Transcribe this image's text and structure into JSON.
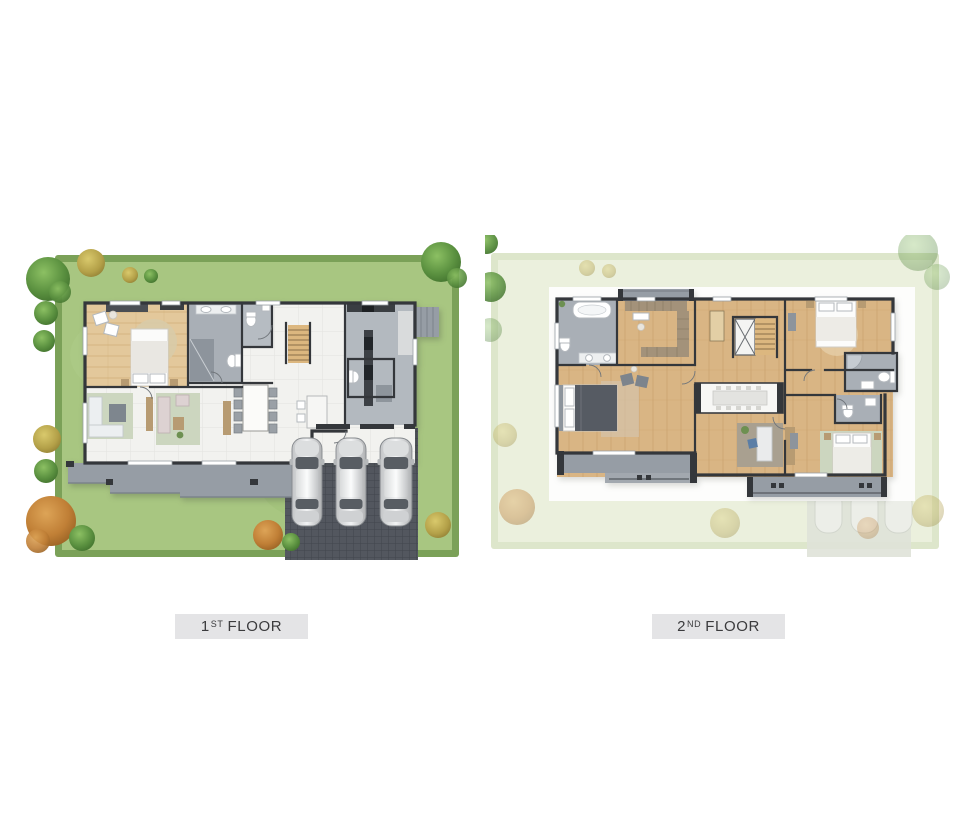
{
  "labels": {
    "first_floor": {
      "number": "1",
      "ordinal": "ST",
      "word": "FLOOR"
    },
    "second_floor": {
      "number": "2",
      "ordinal": "ND",
      "word": "FLOOR"
    }
  },
  "colors": {
    "page_bg": "#ffffff",
    "lawn": "#a8c681",
    "hedge": "#7ba158",
    "lawn_faded": "#ebf0dd",
    "hedge_faded": "#dde6cb",
    "wall": "#34373b",
    "tile": "#f2f2ef",
    "wood": "#d9b584",
    "wood_light": "#e3c89b",
    "bath": "#a9afb6",
    "terrace": "#969da5",
    "paver": "#53575f",
    "rug": "#ccd6bf",
    "tan_furniture": "#b79b72",
    "car_silver": "#d9dbdc",
    "label_bg": "#e4e4e6",
    "label_text": "#3b3b3d"
  }
}
